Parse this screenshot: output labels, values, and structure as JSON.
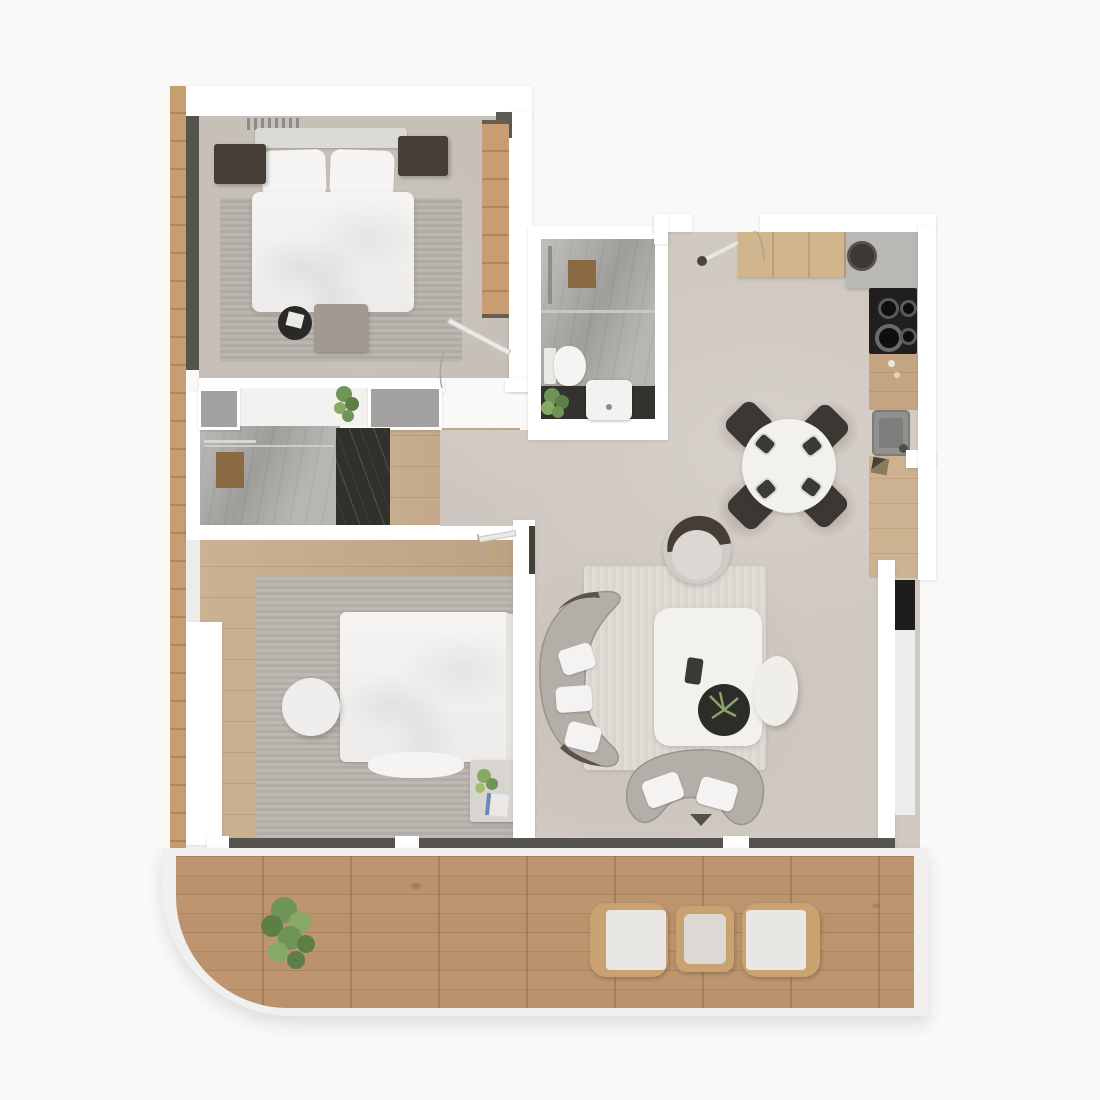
{
  "image": {
    "kind": "apartment-floor-plan-3d-render",
    "view": "top-down",
    "visible_text": "none"
  },
  "palette": {
    "page-bg": "#f9f9f8",
    "wall": "#ffffff",
    "window-dark": "#55544f",
    "frame-black": "#1e1d1c",
    "wood-strip": "#c99d72",
    "deck": "#b68e68",
    "wood-floor": "#c5a987",
    "wood-counter": "#d0b58d",
    "floor-bed1": "#c6c0b8",
    "floor-open": "#d0c9c2",
    "rug-gray": "#b7b1ab",
    "rug-cream": "#dedad3",
    "marble": "#aaa8a5",
    "marble-dark": "#32302b",
    "furn-dark": "#473f37",
    "chair-dark": "#3a3735",
    "cooktop": "#201f1e",
    "counter-gray": "#bab8b5",
    "sink-gray": "#90918f",
    "sofa": "#b3aea8",
    "white-furn": "#f2f1ee",
    "bed-white": "#f3f2f0",
    "mat-brown": "#8a6a42",
    "plant": "#7a9a62",
    "glass": "#ececea"
  },
  "rooms": [
    {
      "id": "bedroom-1",
      "position": "top-left",
      "furniture": [
        "double-bed",
        "headboard",
        "pillows",
        "nightstand-left",
        "nightstand-right",
        "area-rug",
        "round-stool",
        "foot-bench",
        "wardrobe",
        "window-band-left",
        "wall-grille"
      ]
    },
    {
      "id": "bathroom-1",
      "position": "top-middle",
      "furniture": [
        "shower",
        "shower-mat",
        "toilet",
        "vanity-counter",
        "sink",
        "plant"
      ]
    },
    {
      "id": "hallway-bathroom-2",
      "position": "middle-left",
      "furniture": [
        "closet-left",
        "closet-right",
        "shower-area",
        "shower-mat",
        "dark-marble-wall",
        "plant"
      ]
    },
    {
      "id": "kitchen-dining",
      "position": "top-right",
      "furniture": [
        "entry-door",
        "upper-counter-wood",
        "corner-counter-gray",
        "round-sink",
        "cooktop-4-burners",
        "mid-counter",
        "kitchen-sink",
        "lower-counter",
        "round-dining-table",
        "dining-chairs-x4"
      ]
    },
    {
      "id": "bedroom-2",
      "position": "middle-left-lower",
      "furniture": [
        "double-bed",
        "headboard-right",
        "area-rug",
        "round-pouf",
        "bench-with-plant",
        "door"
      ]
    },
    {
      "id": "living-room",
      "position": "middle-right",
      "furniture": [
        "curved-sofa-left",
        "curved-sofa-bottom",
        "coffee-table",
        "tray-with-plant",
        "lounge-chair",
        "oval-ottoman",
        "cream-rug",
        "window-wall-right"
      ]
    },
    {
      "id": "terrace",
      "position": "bottom",
      "furniture": [
        "wood-deck",
        "plant",
        "outdoor-chair-left",
        "outdoor-side-table",
        "outdoor-chair-right",
        "window-band"
      ]
    }
  ]
}
